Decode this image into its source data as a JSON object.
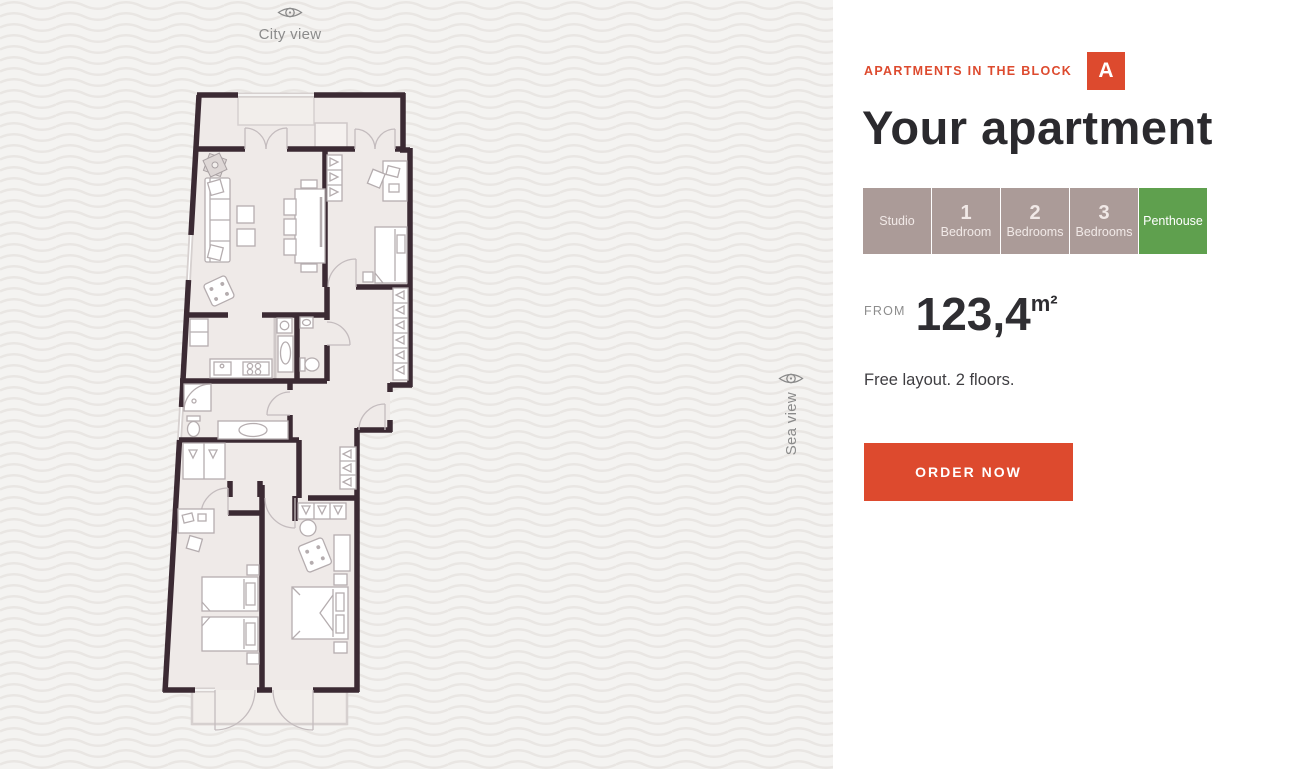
{
  "view_labels": {
    "top": "City view",
    "side": "Sea view"
  },
  "panel": {
    "eyebrow": "APARTMENTS IN THE BLOCK",
    "badge": "A",
    "title": "Your apartment",
    "tabs": [
      {
        "number": "",
        "label": "Studio",
        "selected": false
      },
      {
        "number": "1",
        "label": "Bedroom",
        "selected": false
      },
      {
        "number": "2",
        "label": "Bedrooms",
        "selected": false
      },
      {
        "number": "3",
        "label": "Bedrooms",
        "selected": false
      },
      {
        "number": "",
        "label": "Penthouse",
        "selected": true
      }
    ],
    "area": {
      "prefix": "FROM",
      "value": "123,4",
      "unit": "m²"
    },
    "description": "Free layout. 2 floors.",
    "order_button_label": "ORDER NOW"
  },
  "colors": {
    "accent": "#dd4a2e",
    "tab": "#ab9b98",
    "tab_selected": "#5fa04e",
    "heading": "#2b2a2e",
    "plan_wall": "#3b2a33",
    "plan_floor": "#efeae8",
    "left_background": "#f4f3f1"
  }
}
